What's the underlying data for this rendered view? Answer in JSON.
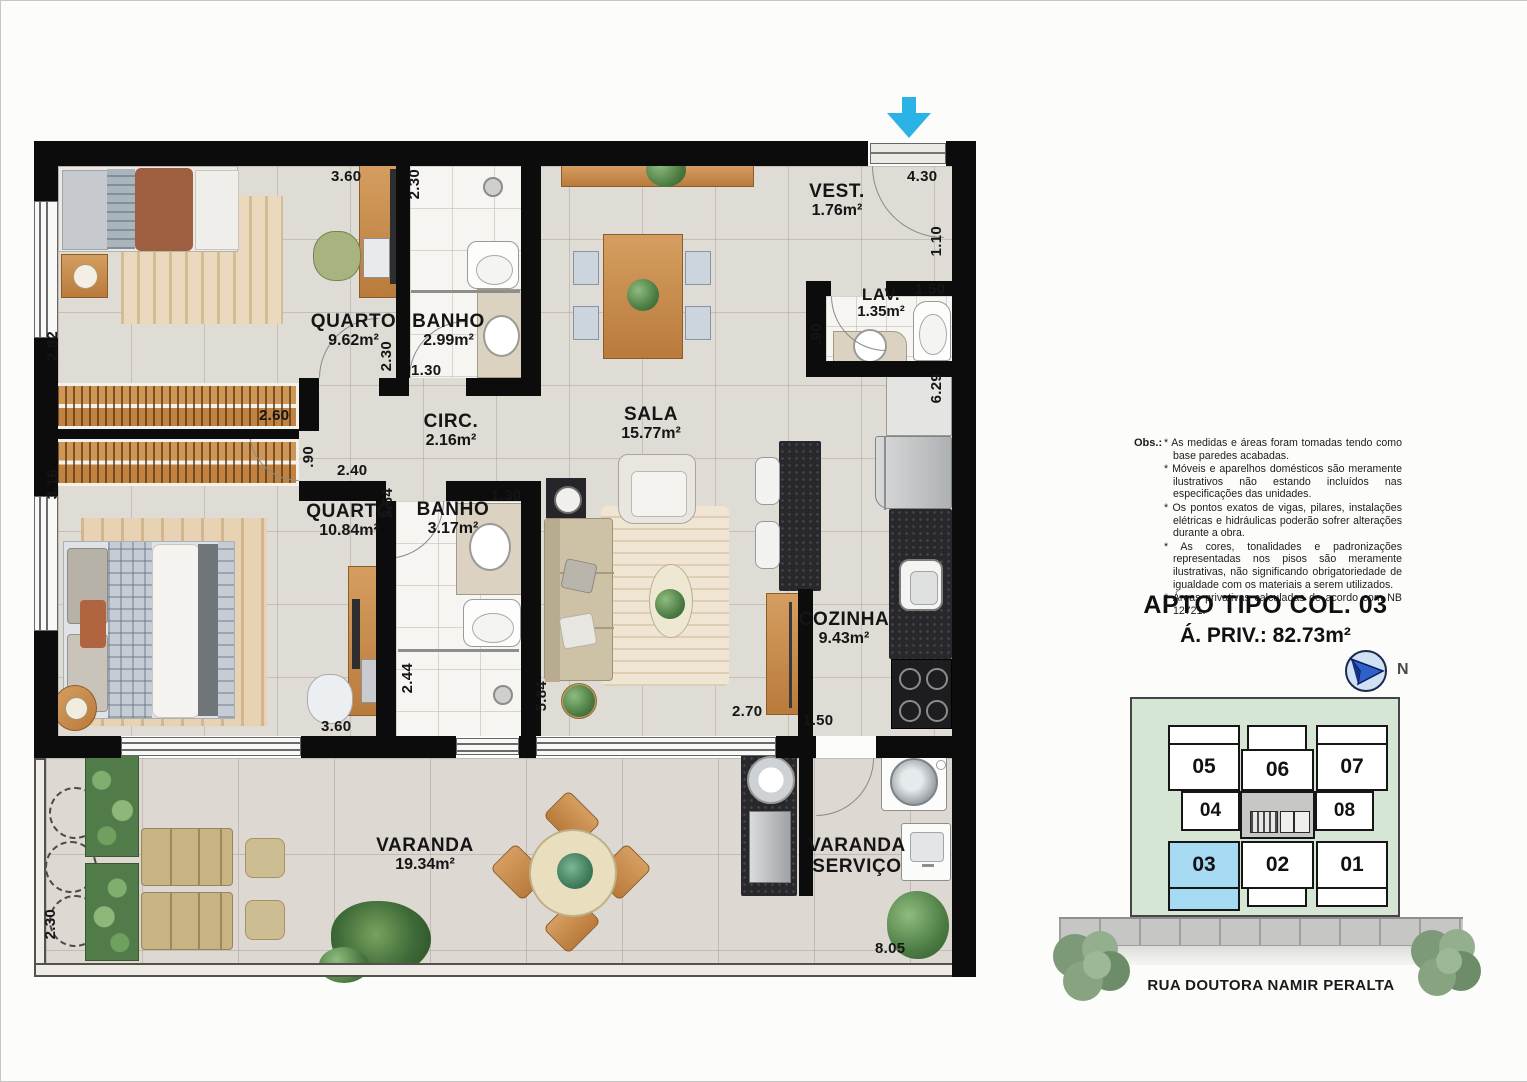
{
  "plan": {
    "rooms": {
      "quarto1": {
        "name": "QUARTO",
        "area": "9.62m²"
      },
      "banho1": {
        "name": "BANHO",
        "area": "2.99m²"
      },
      "circ": {
        "name": "CIRC.",
        "area": "2.16m²"
      },
      "quarto2": {
        "name": "QUARTO",
        "area": "10.84m²"
      },
      "banho2": {
        "name": "BANHO",
        "area": "3.17m²"
      },
      "sala": {
        "name": "SALA",
        "area": "15.77m²"
      },
      "vest": {
        "name": "VEST.",
        "area": "1.76m²"
      },
      "lav": {
        "name": "LAV.",
        "area": "1.35m²"
      },
      "cozinha": {
        "name": "COZINHA",
        "area": "9.43m²"
      },
      "varanda": {
        "name": "VARANDA",
        "area": "19.34m²"
      },
      "varanda_servico": {
        "line1": "VARANDA",
        "line2": "SERVIÇO"
      }
    },
    "dims": {
      "q1_top": "3.60",
      "b1_left": "2.30",
      "vest_top": "4.30",
      "vest_right": "1.10",
      "lav_top": "1.50",
      "lav_left": ".90",
      "coz_right": "6.29",
      "q1_left": "2.82",
      "closet1": "2.60",
      "q2_door": ".90",
      "q2_left": "3.16",
      "q1_door": "2.30",
      "b1_bottom": "1.30",
      "circ_bottom": "2.40",
      "q2_door_h": "2.64",
      "b2_top": "1.30",
      "b2_left": "2.44",
      "q2_bottom": "3.60",
      "sala_left": "5.84",
      "sala_bottom": "2.70",
      "coz_door": "1.50",
      "vs_bottom": "8.05",
      "var_left": "2.30"
    }
  },
  "notes": {
    "label": "Obs.:",
    "items": [
      "* As medidas e áreas foram tomadas tendo como base paredes acabadas.",
      "* Móveis e aparelhos domésticos são meramente ilustrativos não estando incluídos nas especificações das unidades.",
      "* Os pontos exatos de vigas, pilares, instalações elétricas e hidráulicas poderão sofrer alterações durante a obra.",
      "* As cores, tonalidades e padronizações representadas nos pisos são meramente ilustrativas, não significando obrigatoriedade de igualdade com os materiais a serem utilizados.",
      "* Áreas privativas calculadas de acordo com NB 12721."
    ]
  },
  "title": {
    "line1": "APTO TIPO COL. 03",
    "line2": "Á. PRIV.: 82.73m²"
  },
  "keyplan": {
    "compass_label": "N",
    "units": {
      "u05": "05",
      "u06": "06",
      "u07": "07",
      "u04": "04",
      "u08": "08",
      "u03": "03",
      "u02": "02",
      "u01": "01"
    },
    "highlighted_unit": "03",
    "street": "RUA DOUTORA NAMIR PERALTA"
  },
  "colors": {
    "entry_arrow": "#2bb3e6",
    "unit_highlight": "#a6d9f2"
  }
}
